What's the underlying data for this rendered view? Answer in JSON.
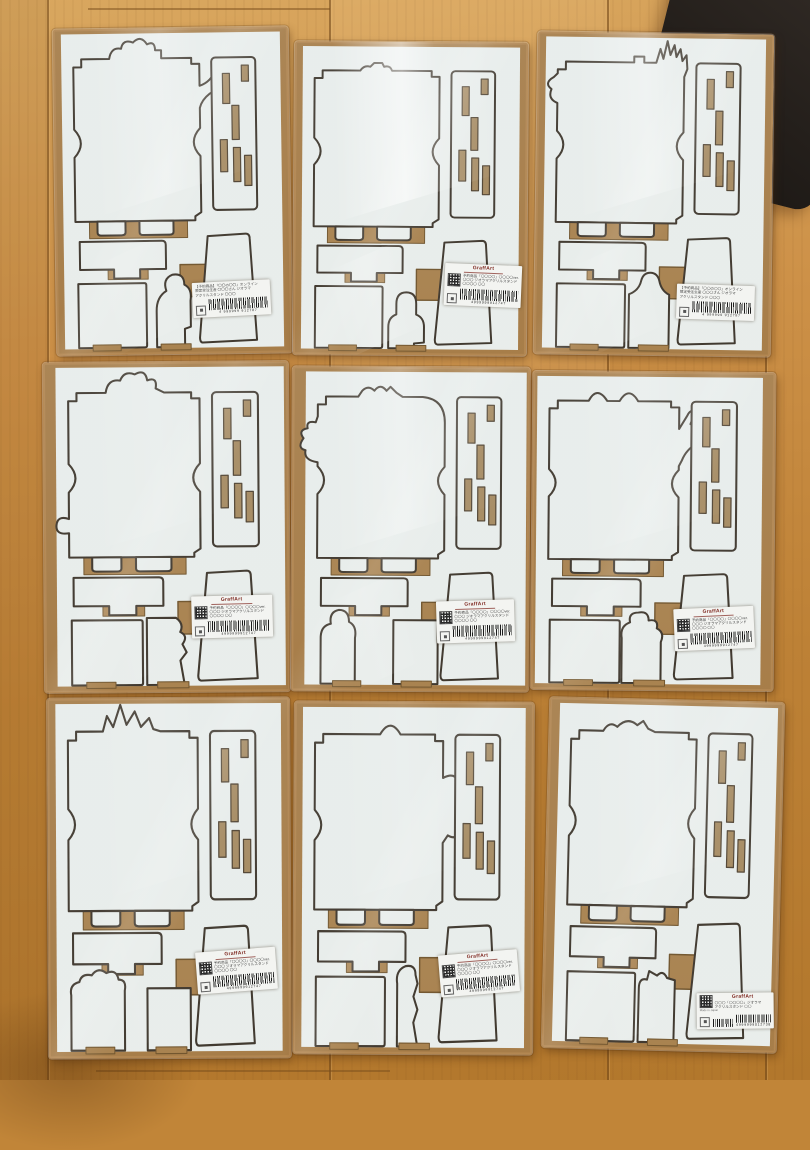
{
  "scene": {
    "floor_base_color": "#c18538",
    "floor_seam_color": "#6e4518",
    "board_color": "#ebefec",
    "kraft_color": "#b2834b",
    "cutline_color": "#3a3126",
    "slot_fill_color": "#a4865a",
    "dark_object_color": "#241f1b",
    "grid": "3x3 shrink-wrapped die-cut craft kit boards on wooden floor"
  },
  "labels": {
    "a": {
      "lines": [
        "【予約商品】「〇〇の〇〇」オンライン",
        "限定受注生産 〇〇〇さん ジオラマ",
        "アクリルスタンド 〇〇〇"
      ],
      "barcode_digits": "4 999999 912787"
    },
    "b": {
      "logo": "GraffArt",
      "lines": [
        "予約商品「〇〇〇〇」〇〇〇〇ver.",
        "〇〇〇 ジオラマアクリルスタンド",
        "〇〇〇〇 〇〇"
      ],
      "barcode_digits": "4999999912747"
    },
    "c": {
      "logo": "GraffArt",
      "lines": [
        "〇〇〇「〇〇〇〇」ジオラマ",
        "アクリルスタンド 〇〇"
      ],
      "made_in": "Made in Japan",
      "barcode_digits": "4999999012738"
    }
  },
  "packages": [
    {
      "id": "pkg-1",
      "x": 55,
      "y": 28,
      "w": 235,
      "h": 326,
      "rot": -0.8,
      "glare": 0.38,
      "sheet_dx": 0,
      "silhouette": "smoke-curls-and-arm",
      "frame_d": "M20,192 L20,128 Q33,114 20,100 L20,44 L20,38 L28,38 L28,30 L44,30 L56,30 Q58,18 68,20 Q70,10 80,14 Q88,6 94,16 Q102,12 102,22 L108,22 L108,30 L138,30 L138,36 L146,36 L146,44 L146,58 Q158,54 162,42 Q164,34 172,36 Q180,38 175,48 Q168,60 156,66 Q148,72 146,80 L146,100 Q133,114 146,128 L146,184 L140,188 L140,192 Z",
      "figure_d": "M100,318 L100,282 Q100,268 110,262 Q106,250 116,246 Q128,244 128,256 Q136,260 134,272 L134,298 L128,300 L128,318 Z",
      "bl_d": "M22,254 L88,254 Q90,254 90,256 L90,316 Q90,318 88,318 L22,318 Z",
      "label": {
        "type": "a",
        "left": 58,
        "top": 78,
        "rot": -2
      }
    },
    {
      "id": "pkg-2",
      "x": 294,
      "y": 42,
      "w": 233,
      "h": 313,
      "rot": 0.4,
      "glare": 0.85,
      "sheet_dx": 0,
      "silhouette": "small-bumps",
      "frame_d": "M20,192 L20,128 Q33,114 20,100 L20,44 L20,38 L28,38 L28,30 L44,30 L66,30 Q70,24 76,26 L80,22 L88,22 L90,26 Q96,24 98,30 L138,30 L138,36 L146,36 L146,44 L146,100 Q133,114 146,128 L146,184 L140,188 L140,192 Z",
      "figure_d": "M96,318 L96,296 Q96,286 104,283 L104,272 Q104,260 114,260 Q124,260 124,272 L124,283 Q132,286 132,296 L132,312 L122,313 L122,318 Z",
      "bl_d": "M22,254 L88,254 Q90,254 90,256 L90,316 Q90,318 88,318 L22,318 Z",
      "label": {
        "type": "b",
        "left": 65,
        "top": 71,
        "rot": 2
      }
    },
    {
      "id": "pkg-3",
      "x": 536,
      "y": 33,
      "w": 236,
      "h": 322,
      "rot": 0.8,
      "glare": 0.5,
      "sheet_dx": 0,
      "silhouette": "feather-fan-and-curls",
      "frame_d": "M20,192 L20,128 Q33,114 20,100 L20,72 Q10,68 14,58 Q6,52 16,46 L20,42 L20,38 L28,38 L28,30 L44,30 L96,30 L96,24 L106,24 L106,30 L118,30 L122,16 L125,26 L129,8 L132,22 L136,12 L138,24 L142,16 L144,28 L148,22 L149,36 L146,44 L146,100 Q133,114 146,128 L146,184 L140,188 L140,192 Z",
      "figure_d": "M94,318 L94,264 Q104,260 106,250 Q108,242 115,242 Q122,242 124,250 Q126,260 134,264 L134,318 Z",
      "bl_d": "M22,254 L88,254 Q90,254 90,256 L90,316 Q90,318 88,318 L22,318 Z",
      "label": {
        "type": "a",
        "left": 60,
        "top": 78,
        "rot": 1
      }
    },
    {
      "id": "pkg-4",
      "x": 44,
      "y": 362,
      "w": 245,
      "h": 330,
      "rot": -0.4,
      "glare": 0.15,
      "sheet_dx": 4,
      "silhouette": "cloud-top-left-blob",
      "frame_d": "M20,192 L20,168 Q7,170 8,160 Q9,150 20,154 L20,128 Q33,114 20,100 L20,44 L20,38 L28,38 L28,30 L44,30 L56,30 Q58,16 70,18 Q74,8 84,12 Q94,6 96,18 Q106,14 104,26 L112,30 L138,30 L138,36 L146,36 L146,44 L146,100 Q133,114 146,128 L146,184 L140,188 L140,192 Z",
      "figure_d": "M94,318 L94,252 L122,252 Q130,258 126,266 Q134,270 128,278 L132,286 L126,294 L130,318 Z",
      "bl_d": "M22,254 L88,254 Q90,254 90,256 L90,316 Q90,318 88,318 L22,318 Z",
      "label": {
        "type": "b",
        "left": 60,
        "top": 71,
        "rot": -1
      }
    },
    {
      "id": "pkg-5",
      "x": 292,
      "y": 367,
      "w": 237,
      "h": 324,
      "rot": 0.3,
      "glare": 0.42,
      "sheet_dx": 5,
      "silhouette": "claw-left-humps-top",
      "frame_d": "M20,192 L20,128 Q33,114 20,100 L20,96 Q6,94 8,84 Q-1,82 6,72 Q0,64 10,62 Q8,54 18,56 L20,50 L20,38 L28,38 L28,30 L44,30 L60,30 L64,24 Q70,18 76,24 Q82,16 88,24 L92,20 L98,26 L104,30 L124,30 Q146,32 146,56 L146,100 Q133,114 146,128 L146,184 L140,188 L140,192 Z",
      "figure_d": "M96,254 L140,254 L140,318 L96,318 Z",
      "bl_d": "M24,318 L24,272 Q24,260 34,258 Q32,246 42,244 Q52,244 52,256 Q60,260 58,272 L58,318 Z",
      "label": {
        "type": "b",
        "left": 61,
        "top": 72,
        "rot": -2
      }
    },
    {
      "id": "pkg-6",
      "x": 532,
      "y": 372,
      "w": 242,
      "h": 318,
      "rot": 0.5,
      "glare": 0.2,
      "sheet_dx": -4,
      "silhouette": "double-bumps-spread-hand",
      "frame_d": "M20,192 L20,128 Q33,114 20,100 L20,44 L20,38 L28,38 L28,30 L44,30 L58,30 Q66,14 76,30 L88,30 Q97,14 106,30 L138,30 L138,36 L146,36 L146,44 L146,58 L154,44 Q157,37 161,41 L157,53 Q166,41 170,46 L163,57 Q173,50 175,56 L166,64 Q175,62 174,68 L164,72 Q153,79 149,90 L146,96 L146,100 Q133,114 146,128 L146,184 L140,188 L140,192 Z",
      "figure_d": "M92,318 L92,272 Q90,260 100,256 Q98,246 108,246 Q118,244 118,254 Q128,252 126,262 Q134,266 130,276 L130,318 Z",
      "bl_d": "M22,254 L88,254 Q90,254 90,256 L90,316 Q90,318 88,318 L22,318 Z",
      "label": {
        "type": "b",
        "left": 59,
        "top": 74,
        "rot": -3
      }
    },
    {
      "id": "pkg-7",
      "x": 48,
      "y": 698,
      "w": 242,
      "h": 360,
      "rot": -0.3,
      "glare": 0.12,
      "sheet_dx": 0,
      "silhouette": "grass-spikes",
      "frame_d": "M20,192 L20,128 Q33,114 20,100 L20,44 L20,38 L28,38 L28,30 L44,30 L54,30 L58,16 L64,26 L71,6 L77,24 L85,12 L91,26 L99,18 L103,28 L110,30 L138,30 L138,36 L146,36 L146,44 L146,100 Q133,114 146,128 L146,184 L140,188 L140,192 Z",
      "figure_d": "M96,262 L138,262 L138,318 L96,318 Z",
      "bl_d": "M22,268 Q20,258 30,256 Q32,248 42,250 Q48,242 56,248 Q66,244 68,254 Q76,254 74,264 L74,318 L22,318 Z",
      "label": {
        "type": "b",
        "left": 61,
        "top": 70,
        "rot": -4
      }
    },
    {
      "id": "pkg-8",
      "x": 294,
      "y": 702,
      "w": 239,
      "h": 352,
      "rot": 0.3,
      "glare": 0.15,
      "sheet_dx": 0,
      "silhouette": "bump-top-paw-right",
      "frame_d": "M20,192 L20,128 Q33,114 20,100 L20,44 L20,38 L28,38 L28,30 L44,30 L84,30 Q94,14 104,30 L138,30 L138,36 L146,36 L146,44 L146,70 Q158,64 161,74 Q172,70 173,82 Q183,84 179,95 Q186,104 176,109 Q176,120 165,118 Q160,128 151,123 L146,130 L146,184 L140,188 L140,192 Z",
      "figure_d": "M102,318 L102,260 Q100,248 110,244 Q120,242 120,252 L122,260 L118,272 L122,284 L118,296 L122,318 Z",
      "bl_d": "M22,254 L88,254 Q90,254 90,256 L90,316 Q90,318 88,318 L22,318 Z",
      "label": {
        "type": "b",
        "left": 61,
        "top": 71,
        "rot": -5
      }
    },
    {
      "id": "pkg-9",
      "x": 546,
      "y": 700,
      "w": 234,
      "h": 350,
      "rot": 1.4,
      "glare": 0.22,
      "sheet_dx": 2,
      "silhouette": "gentle-humps",
      "frame_d": "M20,192 L20,128 Q33,114 20,100 L20,44 L20,38 L28,38 L28,30 L44,30 L52,30 Q58,20 66,26 Q76,16 86,24 L92,20 L97,27 L104,30 L138,30 L138,36 L146,36 L146,44 L146,100 Q133,114 146,128 L146,184 L140,188 L140,192 Z",
      "figure_d": "M94,318 L94,268 Q94,258 102,260 L104,252 L112,256 Q118,250 122,258 L130,260 L130,318 Z",
      "bl_d": "M22,254 L88,254 Q90,254 90,256 L90,316 Q90,318 88,318 L22,318 Z",
      "label": {
        "type": "c",
        "left": 66,
        "top": 83,
        "rot": -2
      }
    }
  ]
}
